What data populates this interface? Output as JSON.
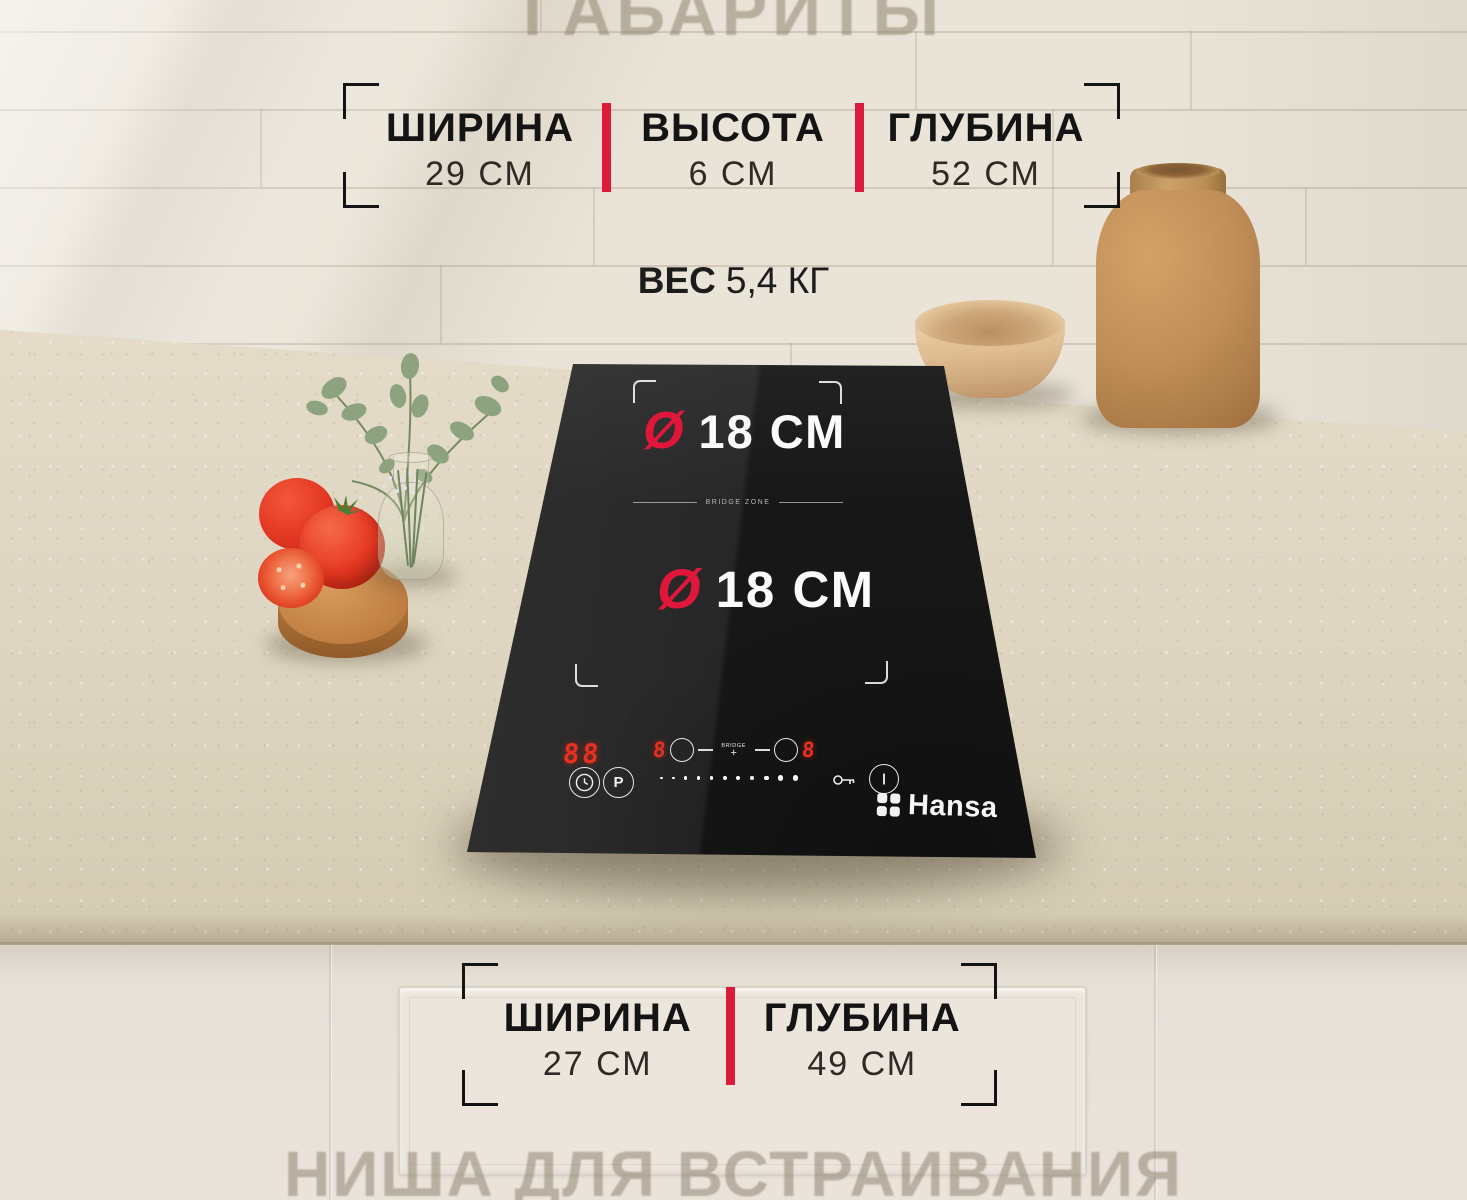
{
  "watermarks": {
    "top": "ГАБАРИТЫ",
    "bottom": "НИША ДЛЯ ВСТРАИВАНИЯ"
  },
  "dimensions_top": {
    "items": [
      {
        "label": "ШИРИНА",
        "value": "29 СМ"
      },
      {
        "label": "ВЫСОТА",
        "value": "6 СМ"
      },
      {
        "label": "ГЛУБИНА",
        "value": "52 СМ"
      }
    ]
  },
  "weight": {
    "label": "ВЕС",
    "value": "5,4 КГ"
  },
  "cooktop": {
    "brand": "Hansa",
    "zone1": {
      "symbol": "Ø",
      "value": "18 СМ"
    },
    "zone2": {
      "symbol": "Ø",
      "value": "18 СМ"
    },
    "bridge_zone_label": "BRIDGE ZONE",
    "controls": {
      "display_left": "88",
      "timer_icon": "clock",
      "boost_label": "P",
      "display_bridge_left": "8",
      "bridge_label": "BRIDGE",
      "bridge_plus": "+",
      "display_bridge_right": "8",
      "slider_dots": 11,
      "lock_icon": "key",
      "power_icon": "power"
    }
  },
  "dimensions_bottom": {
    "items": [
      {
        "label": "ШИРИНА",
        "value": "27 СМ"
      },
      {
        "label": "ГЛУБИНА",
        "value": "49 СМ"
      }
    ]
  },
  "colors": {
    "accent_red": "#dc1a3c",
    "display_red": "#e73020",
    "cooktop_black": "#171717",
    "text_black": "#141414",
    "wall_beige": "#eae4d8"
  }
}
